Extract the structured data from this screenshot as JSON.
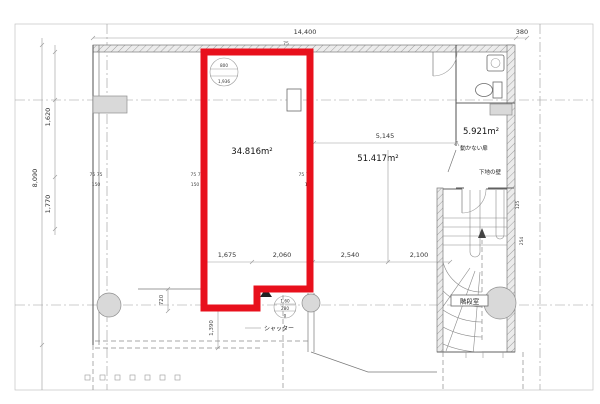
{
  "drawing": {
    "title": "floor-plan",
    "highlight_color": "#e8101c",
    "areas": {
      "highlighted": "34.816m²",
      "center": "51.417m²",
      "upper_right": "5.921m²"
    },
    "rooms": {
      "stairwell": "階段室"
    },
    "annotations": {
      "shutter": "シャッター",
      "fixed_door": "動かない扉",
      "base_wall": "下地の壁"
    },
    "dimensions": {
      "top_overall": "14,400",
      "top_wall": "75",
      "top_right": "380",
      "left_upper": "1,620",
      "left_overall": "8,090",
      "left_lower": "1,770",
      "mid_span": "5,145",
      "bottom_row": [
        "1,675",
        "2,060",
        "2,540",
        "2,100"
      ],
      "step": "720",
      "shutter_opening": "1,390",
      "right_wall_upper": "125",
      "right_wall_lower": "254",
      "wall_pair": "75 75",
      "wall_single": "150"
    },
    "marks": {
      "upper_circle_top": "800",
      "upper_circle_bottom": "1,936",
      "level_top": "1,60",
      "level_mid": "280",
      "level_bottom": "0"
    }
  }
}
